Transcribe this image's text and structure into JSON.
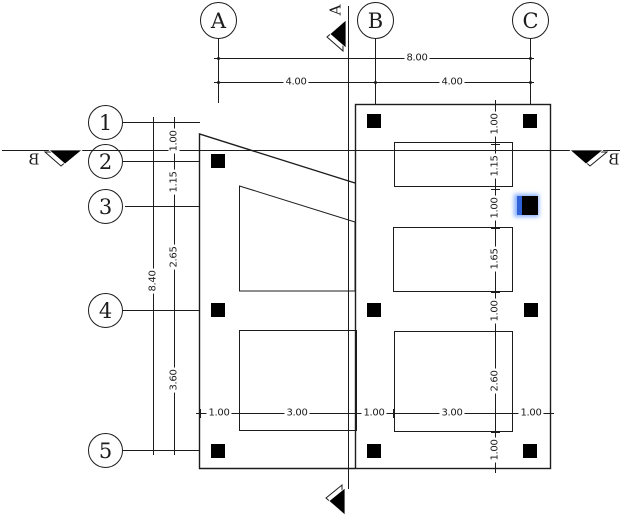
{
  "grid_columns": [
    {
      "label": "A"
    },
    {
      "label": "B"
    },
    {
      "label": "C"
    }
  ],
  "grid_rows": [
    {
      "label": "1"
    },
    {
      "label": "2"
    },
    {
      "label": "3"
    },
    {
      "label": "4"
    },
    {
      "label": "5"
    }
  ],
  "section_markers": {
    "vertical_cut": "A",
    "horizontal_cut_left": "B",
    "horizontal_cut_right": "B"
  },
  "dimensions": {
    "top_total": "8.00",
    "top_spans": [
      "4.00",
      "4.00"
    ],
    "left_total": "8.40",
    "left_spans": [
      "1.00",
      "1.15",
      "2.65",
      "3.60"
    ],
    "right_spans": [
      "1.00",
      "1.15",
      "1.00",
      "1.65",
      "1.00",
      "2.60",
      "1.00"
    ],
    "bottom_spans": [
      "1.00",
      "3.00",
      "1.00",
      "3.00",
      "1.00"
    ]
  },
  "colors": {
    "line": "#1c1c1c",
    "column_fill": "#000000",
    "selection_stripe": "#2f62d9",
    "selection_glow": "#7da8ff"
  }
}
